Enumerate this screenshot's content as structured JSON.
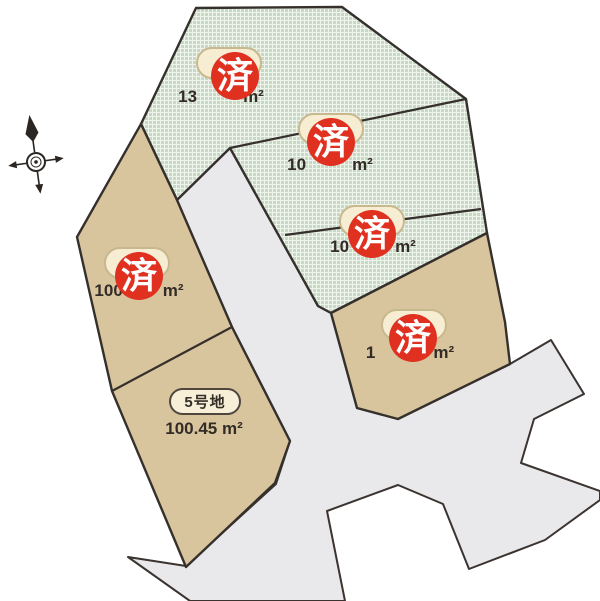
{
  "map": {
    "title": "land-lot-subdivision-map",
    "stamp_char": "済",
    "lots": [
      {
        "id": "lot-1",
        "status": "sold",
        "area_prefix": "13",
        "area_suffix": "m²"
      },
      {
        "id": "lot-2",
        "status": "sold",
        "area_prefix": "10",
        "area_suffix": "m²"
      },
      {
        "id": "lot-3",
        "status": "sold",
        "area_prefix": "10",
        "area_suffix": "m²"
      },
      {
        "id": "lot-4",
        "status": "sold",
        "area_prefix": "100",
        "area_suffix": "m²"
      },
      {
        "id": "lot-5",
        "status": "available",
        "label": "5号地",
        "area": "100.45 m²"
      },
      {
        "id": "lot-6",
        "status": "sold",
        "area_prefix": "1",
        "area_suffix": "m²"
      }
    ],
    "colors": {
      "sold_lot_green": "#c7d9c5",
      "available_lot_tan": "#d8c59d",
      "road_gray": "#e9e9eb",
      "stamp_red": "#e03120",
      "label_cream": "#f6edd3",
      "boundary_line": "#35302c"
    }
  }
}
